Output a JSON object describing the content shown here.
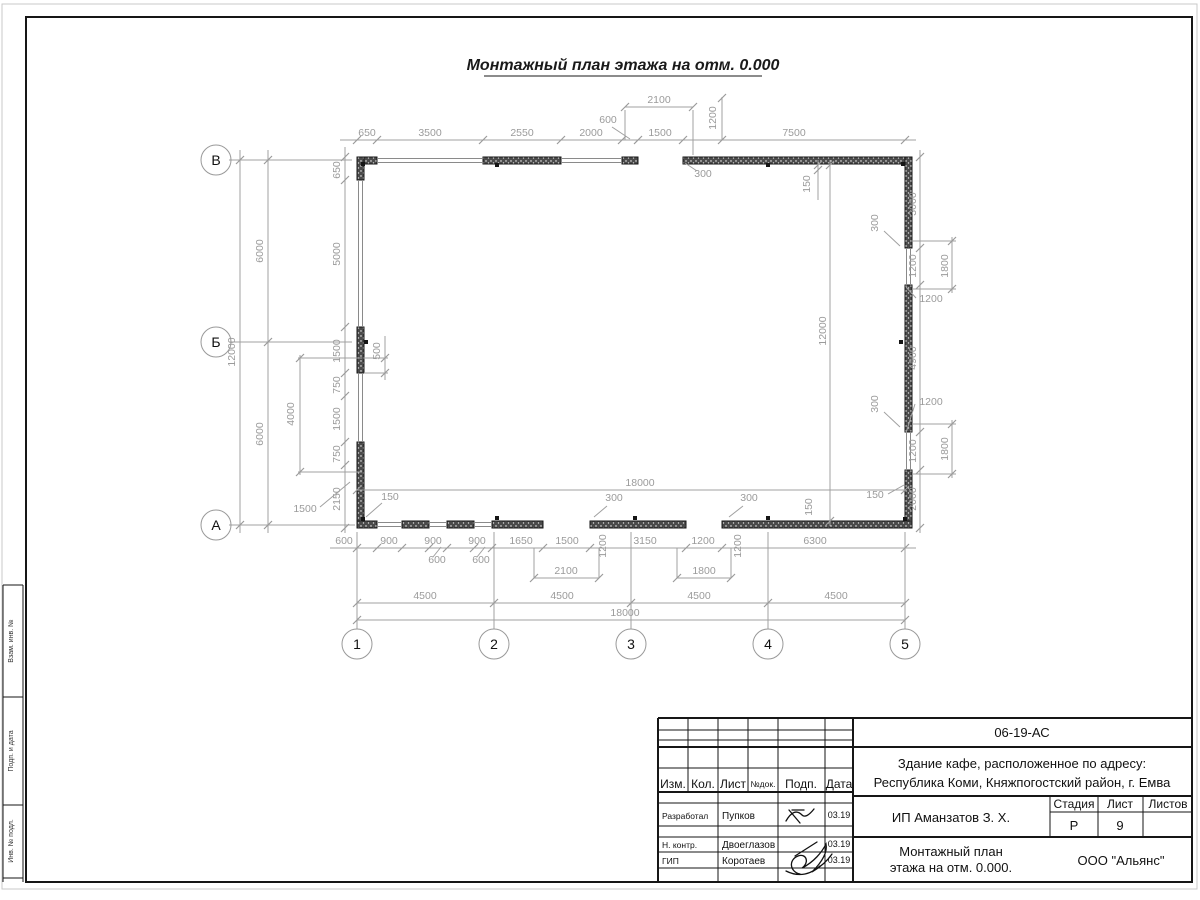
{
  "sheet": {
    "title": "Монтажный план этажа на отм. 0.000",
    "side_stamp": [
      "Взам. инв. №",
      "Подп. и дата",
      "Инв. № подл."
    ]
  },
  "plan": {
    "axes": {
      "rows": [
        "В",
        "Б",
        "А"
      ],
      "cols": [
        "1",
        "2",
        "3",
        "4",
        "5"
      ]
    },
    "dims": [
      {
        "t": "650",
        "x": 367,
        "y": 136
      },
      {
        "t": "3500",
        "x": 430,
        "y": 136
      },
      {
        "t": "2550",
        "x": 522,
        "y": 136
      },
      {
        "t": "2000",
        "x": 591,
        "y": 136
      },
      {
        "t": "1500",
        "x": 660,
        "y": 136
      },
      {
        "t": "7500",
        "x": 794,
        "y": 136
      },
      {
        "t": "2100",
        "x": 659,
        "y": 103
      },
      {
        "t": "600",
        "x": 608,
        "y": 123
      },
      {
        "t": "1200",
        "x": 716,
        "y": 118,
        "r": 1
      },
      {
        "t": "300",
        "x": 703,
        "y": 177
      },
      {
        "t": "150",
        "x": 810,
        "y": 184,
        "r": 1
      },
      {
        "t": "650",
        "x": 340,
        "y": 170,
        "r": 1
      },
      {
        "t": "5000",
        "x": 340,
        "y": 254,
        "r": 1
      },
      {
        "t": "1500",
        "x": 340,
        "y": 351,
        "r": 1
      },
      {
        "t": "750",
        "x": 340,
        "y": 385,
        "r": 1
      },
      {
        "t": "1500",
        "x": 340,
        "y": 419,
        "r": 1
      },
      {
        "t": "750",
        "x": 340,
        "y": 454,
        "r": 1
      },
      {
        "t": "2150",
        "x": 340,
        "y": 499,
        "r": 1
      },
      {
        "t": "12000",
        "x": 235,
        "y": 352,
        "r": 1
      },
      {
        "t": "6000",
        "x": 263,
        "y": 251,
        "r": 1
      },
      {
        "t": "6000",
        "x": 263,
        "y": 434,
        "r": 1
      },
      {
        "t": "500",
        "x": 380,
        "y": 351,
        "r": 1
      },
      {
        "t": "4000",
        "x": 294,
        "y": 414,
        "r": 1
      },
      {
        "t": "1500",
        "x": 305,
        "y": 512
      },
      {
        "t": "150",
        "x": 390,
        "y": 500
      },
      {
        "t": "600",
        "x": 344,
        "y": 544
      },
      {
        "t": "900",
        "x": 389,
        "y": 544
      },
      {
        "t": "900",
        "x": 433,
        "y": 544
      },
      {
        "t": "900",
        "x": 477,
        "y": 544
      },
      {
        "t": "1650",
        "x": 521,
        "y": 544
      },
      {
        "t": "1500",
        "x": 567,
        "y": 544
      },
      {
        "t": "3150",
        "x": 645,
        "y": 544
      },
      {
        "t": "1200",
        "x": 703,
        "y": 544
      },
      {
        "t": "6300",
        "x": 815,
        "y": 544
      },
      {
        "t": "600",
        "x": 437,
        "y": 563
      },
      {
        "t": "600",
        "x": 481,
        "y": 563
      },
      {
        "t": "1200",
        "x": 606,
        "y": 546,
        "r": 1
      },
      {
        "t": "1200",
        "x": 741,
        "y": 546,
        "r": 1
      },
      {
        "t": "2100",
        "x": 566,
        "y": 574
      },
      {
        "t": "1800",
        "x": 704,
        "y": 574
      },
      {
        "t": "4500",
        "x": 425,
        "y": 599
      },
      {
        "t": "4500",
        "x": 562,
        "y": 599
      },
      {
        "t": "4500",
        "x": 699,
        "y": 599
      },
      {
        "t": "4500",
        "x": 836,
        "y": 599
      },
      {
        "t": "18000",
        "x": 625,
        "y": 616
      },
      {
        "t": "18000",
        "x": 640,
        "y": 486
      },
      {
        "t": "300",
        "x": 614,
        "y": 501
      },
      {
        "t": "300",
        "x": 749,
        "y": 501
      },
      {
        "t": "150",
        "x": 812,
        "y": 507,
        "r": 1
      },
      {
        "t": "150",
        "x": 875,
        "y": 498
      },
      {
        "t": "12000",
        "x": 826,
        "y": 331,
        "r": 1
      },
      {
        "t": "3000",
        "x": 916,
        "y": 204,
        "r": 1
      },
      {
        "t": "1200",
        "x": 916,
        "y": 266,
        "r": 1
      },
      {
        "t": "4900",
        "x": 916,
        "y": 358,
        "r": 1
      },
      {
        "t": "1200",
        "x": 916,
        "y": 451,
        "r": 1
      },
      {
        "t": "2000",
        "x": 916,
        "y": 499,
        "r": 1
      },
      {
        "t": "1800",
        "x": 948,
        "y": 266,
        "r": 1
      },
      {
        "t": "1800",
        "x": 948,
        "y": 449,
        "r": 1
      },
      {
        "t": "300",
        "x": 878,
        "y": 223,
        "r": 1
      },
      {
        "t": "300",
        "x": 878,
        "y": 404,
        "r": 1
      },
      {
        "t": "1200",
        "x": 931,
        "y": 302
      },
      {
        "t": "1200",
        "x": 931,
        "y": 405
      }
    ]
  },
  "titleblock": {
    "doc_number": "06-19-АС",
    "project_line1": "Здание кафе, расположенное по адресу:",
    "project_line2": "Республика Коми, Княжпогостский район, г. Емва",
    "columns": [
      "Изм.",
      "Кол.",
      "Лист",
      "№док.",
      "Подп.",
      "Дата"
    ],
    "rows": [
      {
        "role": "Разработал",
        "name": "Пупков",
        "date": "03.19"
      },
      {
        "role": "Н. контр.",
        "name": "Двоеглазов",
        "date": "03.19"
      },
      {
        "role": "ГИП",
        "name": "Коротаев",
        "date": "03.19"
      }
    ],
    "client": "ИП Аманзатов З. Х.",
    "stage_label": "Стадия",
    "sheet_label": "Лист",
    "sheets_label": "Листов",
    "stage": "Р",
    "sheet_num": "9",
    "drawing_name1": "Монтажный план",
    "drawing_name2": "этажа на отм. 0.000.",
    "company": "ООО \"Альянс\""
  }
}
